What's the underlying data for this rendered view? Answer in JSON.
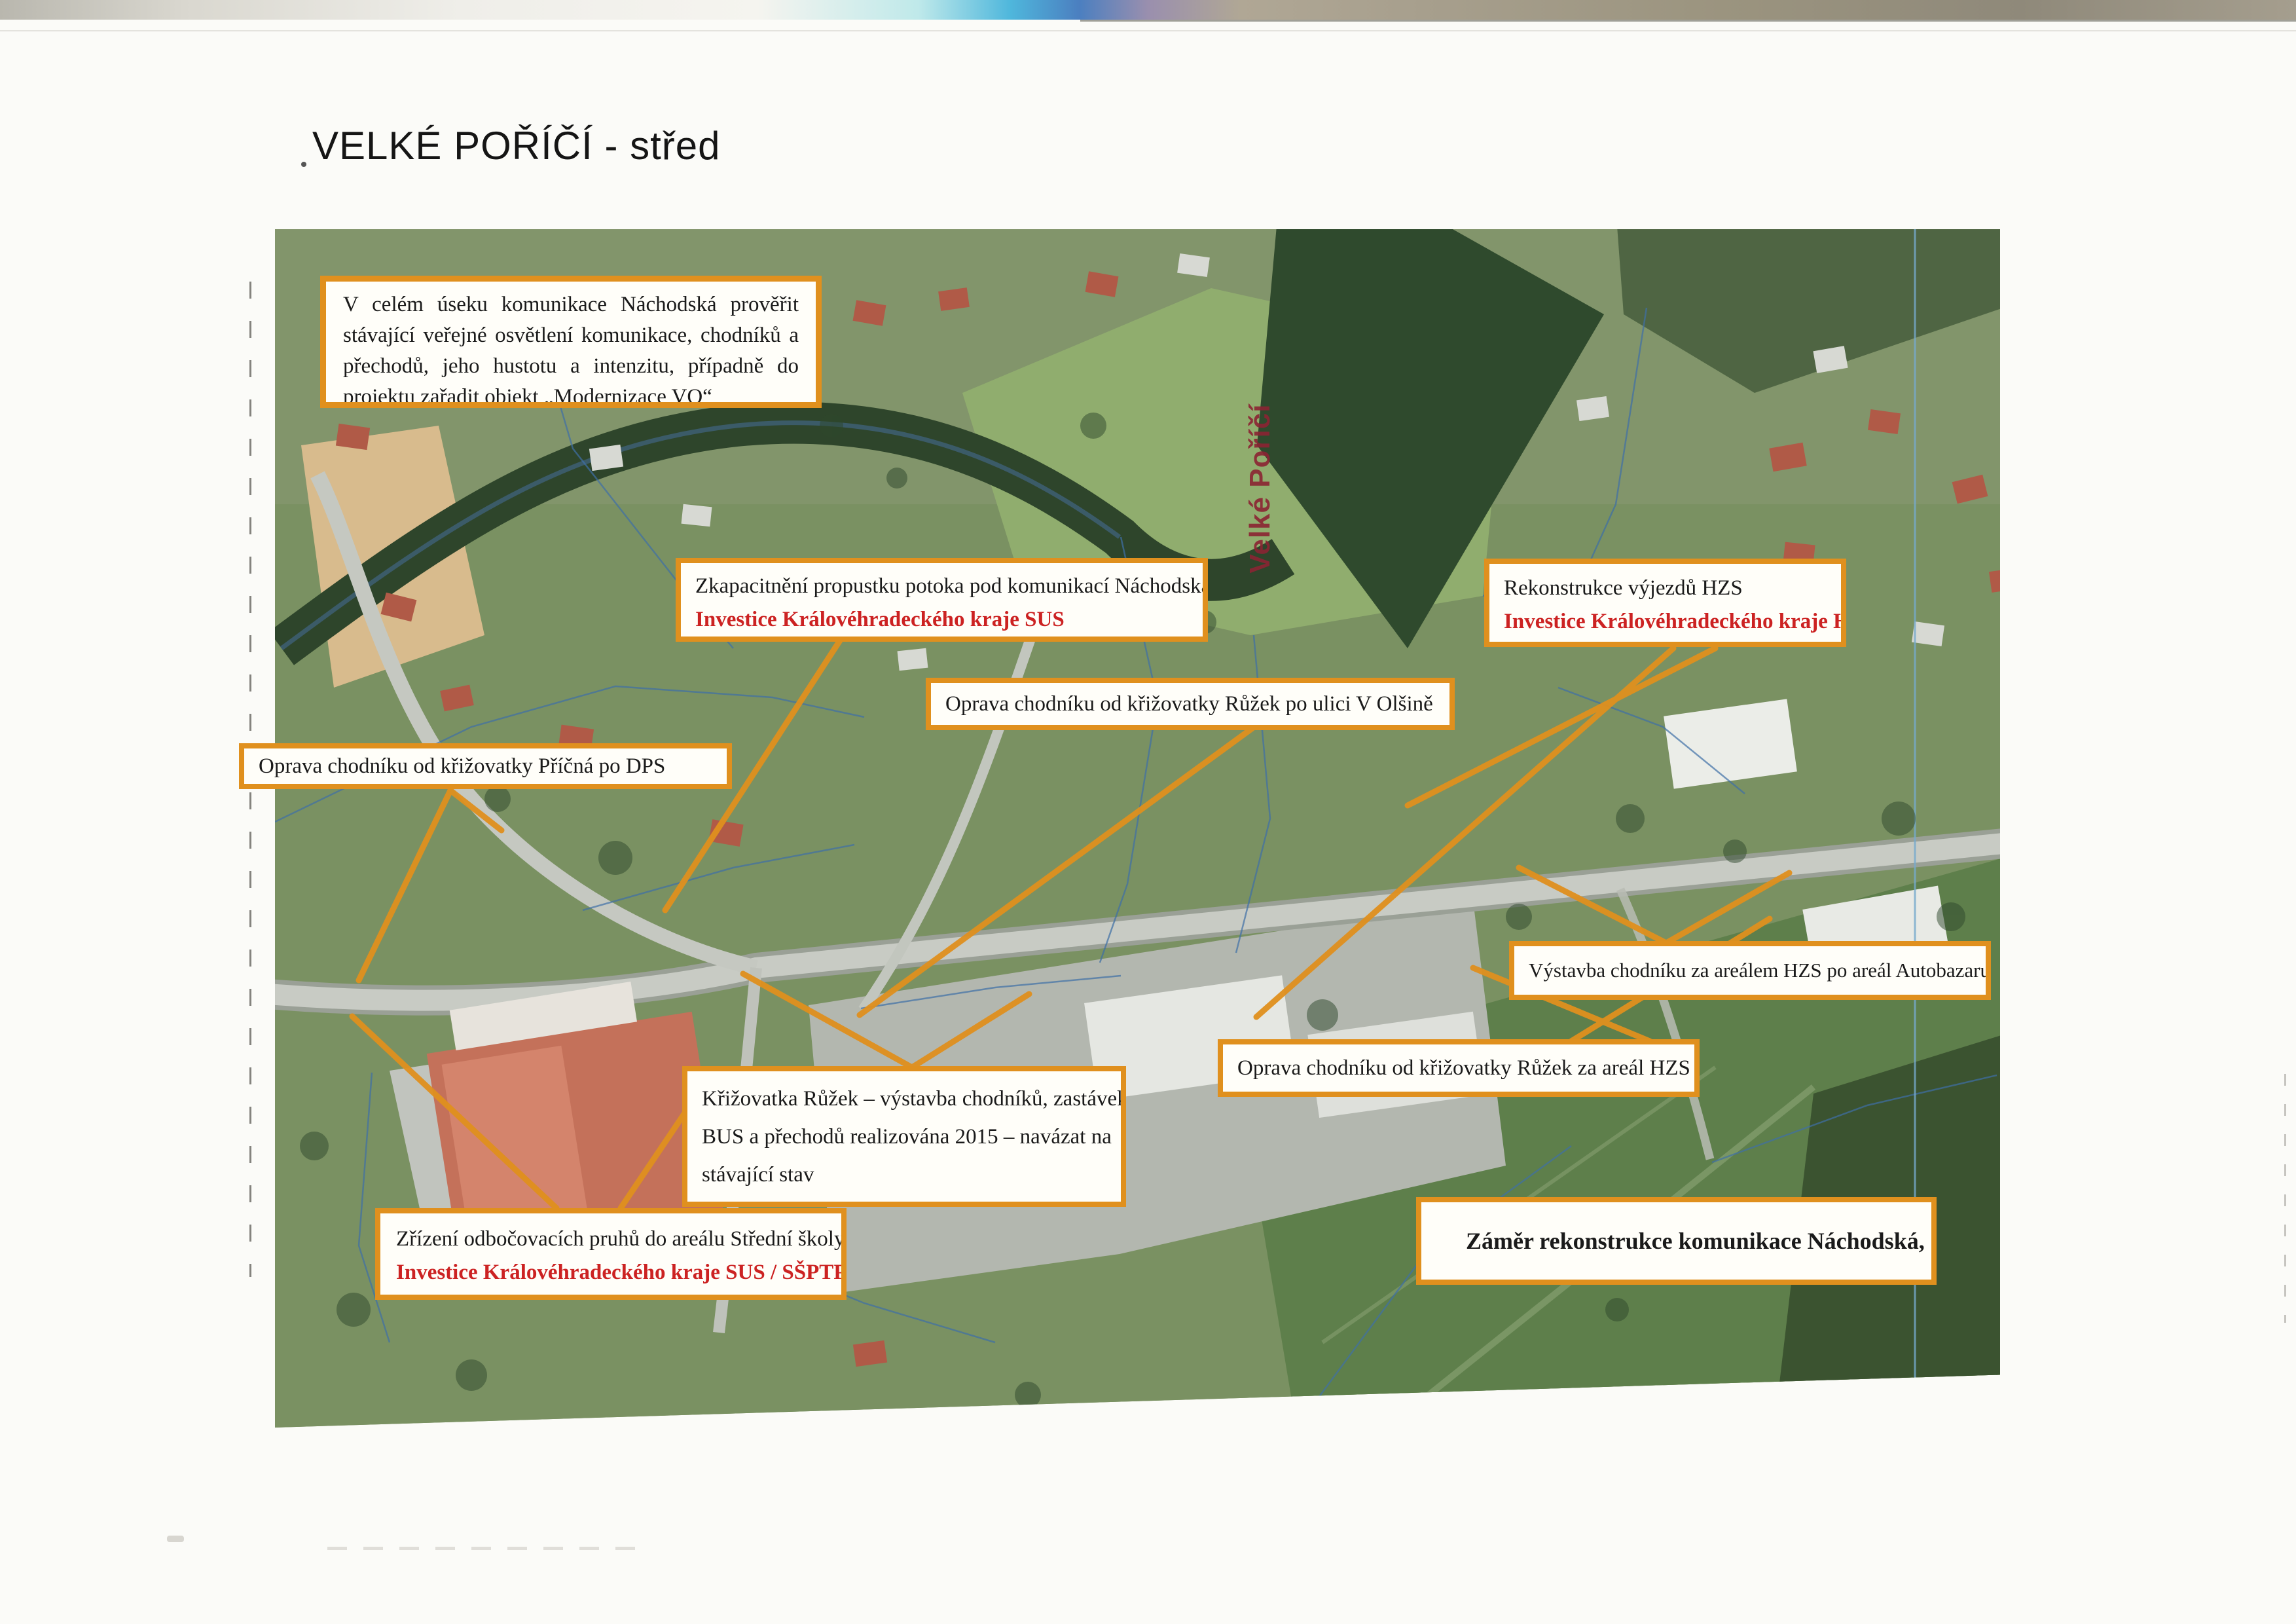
{
  "page": {
    "title": "VELKÉ POŘÍČÍ - střed"
  },
  "map": {
    "river_label": "Velké Poříčí"
  },
  "colors": {
    "accent_orange": "#e0901e",
    "investor_red": "#cc2222",
    "river_label_red": "#8b2433"
  },
  "boxes": {
    "vo": {
      "line1": "V celém úseku komunikace Náchodská prověřit stávající veřejné osvětlení komunikace, chodníků a přechodů, jeho hustotu a intenzitu, případně do projektu zařadit objekt „Modernizace VO“"
    },
    "culvert": {
      "line1": "Zkapacitnění propustku potoka pod komunikací Náchodská",
      "line2": "Investice Královéhradeckého kraje  SUS"
    },
    "hzs": {
      "line1": "Rekonstrukce výjezdů HZS",
      "line2": "Investice Královéhradeckého kraje  HZS"
    },
    "olsina": {
      "line1": "Oprava chodníku od křižovatky Růžek po ulici V Olšině"
    },
    "pricna": {
      "line1": "Oprava chodníku od křižovatky Příčná po DPS"
    },
    "autobazar": {
      "line1": "Výstavba chodníku za areálem HZS po areál Autobazaru"
    },
    "za_hzs": {
      "line1": "Oprava chodníku od křižovatky Růžek za areál HZS"
    },
    "ruzek": {
      "line1": "Křižovatka Růžek – výstavba chodníků, zastávek",
      "line2": "BUS a přechodů realizována 2015 – navázat na",
      "line3": "stávající stav"
    },
    "zrizeni": {
      "line1": "Zřízení odbočovacích pruhů do areálu Střední školy",
      "line2": "Investice Královéhradeckého kraje  SUS / SŠPTP"
    },
    "zamer": {
      "line1": "Záměr rekonstrukce komunikace Náchodská,  2 – střed"
    }
  }
}
